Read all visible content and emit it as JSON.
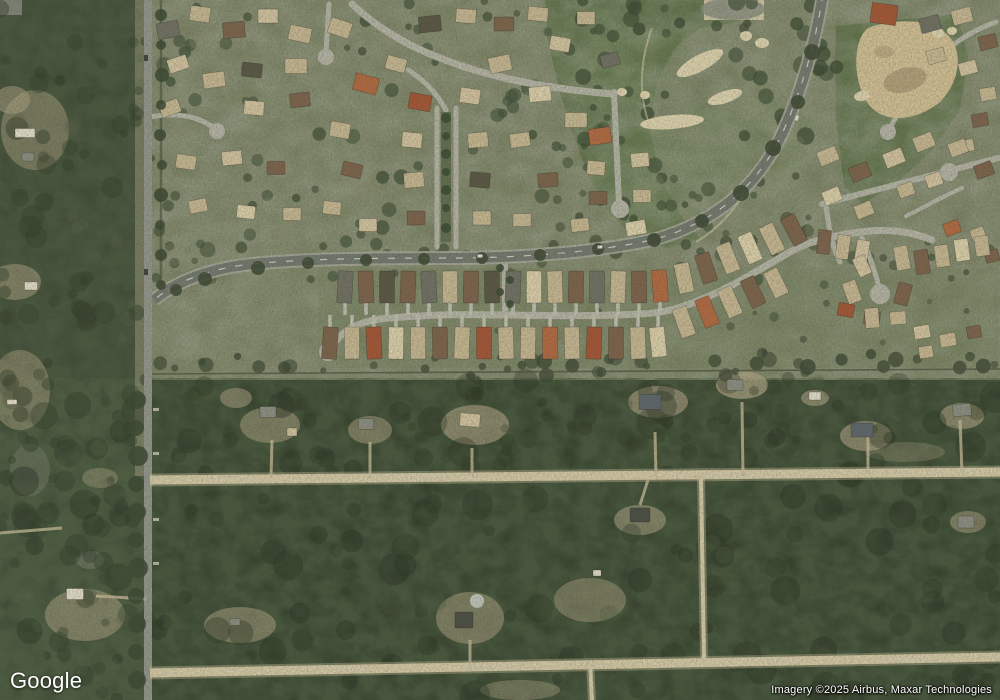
{
  "map": {
    "logo_text": "Google",
    "attribution": "Imagery ©2025 Airbus, Maxar Technologies",
    "palette": {
      "suburbBase": "#7a8161",
      "ruralForest": "#2f3b26",
      "leftForest": "#3a4630",
      "golf": "#5d7046",
      "golfLight": "#6e8052",
      "street": "#b6b5a6",
      "median": "#5f6a4a",
      "roadBed": "#a7a899",
      "mainRoad": "#71766c",
      "verticalRoad": "#92958b",
      "dirt": "#d8cca8",
      "dirtSoft": "#c2b691",
      "sand": "#e2d6b0",
      "waste": "#d5c193",
      "clearing": "#b7a988",
      "wall": "#454c3a",
      "treeDark": "#35432c",
      "centerline": "#f2f2e8",
      "roofs": [
        "#c9b891",
        "#e0d2ab",
        "#7b5f46",
        "#b4663c",
        "#a5512f",
        "#6e6d60",
        "#55523f",
        "#d6c5a0",
        "#e8e1cd",
        "#8a8d80",
        "#5a626a",
        "#454a3e"
      ]
    },
    "base": {
      "suburbRect": [
        150,
        0,
        850,
        380
      ],
      "bandRect": [
        318,
        268,
        680,
        100
      ],
      "leftStripRect": [
        0,
        0,
        150,
        700
      ],
      "golfLeftPoly": "545,0 760,0 756,16 728,24 700,28 676,46 656,84 650,130 660,178 680,214 700,238 668,248 636,238 610,214 590,178 574,138 560,92 548,42",
      "golfRightPoly": "836,26 958,14 968,58 960,110 932,150 896,184 862,204 844,186 836,120 835,60",
      "fairwayLights": [
        [
          700,
          160,
          120,
          55,
          -18,
          0.35
        ],
        [
          630,
          70,
          70,
          38,
          -10,
          0.3
        ],
        [
          900,
          100,
          55,
          60,
          0,
          0.22
        ]
      ]
    },
    "rects": [
      [
        0,
        0,
        22,
        15,
        "#8a8c82",
        0.85
      ],
      [
        135,
        0,
        13,
        476,
        "#a89f82",
        0.5
      ],
      [
        704,
        0,
        60,
        20,
        "#d9cda8",
        0.9
      ],
      [
        318,
        268,
        680,
        100,
        "#76805b",
        0.35
      ]
    ],
    "patches": {
      "tan": [
        [
          270,
          425,
          30,
          18,
          0.5
        ],
        [
          370,
          430,
          22,
          14,
          0.5
        ],
        [
          475,
          425,
          34,
          20,
          0.6
        ],
        [
          658,
          402,
          30,
          16,
          0.6
        ],
        [
          742,
          385,
          26,
          14,
          0.7
        ],
        [
          815,
          398,
          14,
          8,
          0.6
        ],
        [
          866,
          436,
          26,
          15,
          0.6
        ],
        [
          962,
          416,
          22,
          13,
          0.6
        ],
        [
          905,
          452,
          40,
          10,
          0.3
        ],
        [
          640,
          520,
          26,
          15,
          0.55
        ],
        [
          968,
          522,
          18,
          11,
          0.5
        ],
        [
          470,
          618,
          34,
          26,
          0.5
        ],
        [
          590,
          600,
          36,
          22,
          0.45
        ],
        [
          240,
          625,
          36,
          18,
          0.5
        ],
        [
          85,
          615,
          40,
          26,
          0.5
        ],
        [
          20,
          390,
          30,
          40,
          0.45
        ],
        [
          15,
          282,
          26,
          18,
          0.5
        ],
        [
          35,
          130,
          34,
          40,
          0.45
        ],
        [
          12,
          100,
          18,
          14,
          0.5
        ],
        [
          100,
          478,
          18,
          10,
          0.4
        ],
        [
          520,
          690,
          40,
          10,
          0.4
        ],
        [
          236,
          398,
          16,
          10,
          0.5
        ]
      ],
      "gray": [
        [
          733,
          9,
          32,
          11,
          0.9
        ],
        [
          720,
          8,
          7,
          5,
          0.8
        ],
        [
          90,
          560,
          14,
          9,
          0.4
        ],
        [
          30,
          470,
          20,
          26,
          0.3
        ]
      ],
      "pool": [
        477,
        601,
        7,
        7,
        0.9
      ]
    },
    "roads": {
      "streets": [
        {
          "d": "M352,4 C385,35 420,52 462,66 C510,82 560,90 614,94",
          "w": 7
        },
        {
          "d": "M614,92 L619,204",
          "w": 6,
          "bulb": [
            620,
            209,
            9
          ]
        },
        {
          "d": "M437,108 L437,247",
          "w": 5
        },
        {
          "d": "M456,108 L456,247",
          "w": 5
        },
        {
          "d": "M446,110 C436,92 424,80 408,70",
          "w": 5
        },
        {
          "d": "M329,4 L326,52",
          "w": 5,
          "bulb": [
            326,
            57,
            8
          ]
        },
        {
          "d": "M150,117 C176,112 198,116 214,128",
          "w": 5,
          "bulb": [
            217,
            131,
            8
          ]
        },
        {
          "d": "M822,204 L998,158",
          "w": 6,
          "bulb": [
            949,
            172,
            9
          ]
        },
        {
          "d": "M826,206 C830,236 834,252 840,262",
          "w": 5
        },
        {
          "d": "M906,216 C926,206 944,196 962,188",
          "w": 4
        },
        {
          "d": "M996,22 C968,32 948,46 932,66 C916,86 900,108 890,128",
          "w": 5,
          "bulb": [
            888,
            132,
            8
          ]
        },
        {
          "d": "M330,350 C340,330 360,320 390,318 C450,313 470,315 505,315 C560,316 600,316 640,314 C665,313 680,308 700,300 C730,288 755,272 790,252 C805,243 830,236 860,232 C890,228 912,232 932,240",
          "w": 7,
          "bulb": [
            328,
            352,
            9
          ]
        },
        {
          "d": "M505,262 L505,316",
          "w": 6
        },
        {
          "d": "M862,238 C870,256 875,272 879,287",
          "w": 5,
          "bulb": [
            880,
            294,
            10
          ]
        }
      ],
      "medianRect": [
        441,
        112,
        10,
        130
      ],
      "curve": {
        "d": "M823,-6 C816,40 802,92 780,138 C752,194 708,224 656,239 C600,252 520,258 452,258 C372,258 300,259 252,264 C212,268 176,281 154,300",
        "bedW": 14,
        "w": 10,
        "dash": "7 10"
      },
      "vertical": {
        "d": "M148,-4 L148,704",
        "w": 8
      },
      "dirt": [
        {
          "d": "M150,480 C400,477 700,474 1000,472",
          "w": 9
        },
        {
          "d": "M150,673 C400,669 700,662 1000,657",
          "w": 9
        },
        {
          "d": "M701,477 L704,659",
          "w": 4
        },
        {
          "d": "M590,661 L592,702",
          "w": 4
        }
      ],
      "dirtStubs": [
        "M655,432 L656,477",
        "M742,402 L743,476",
        "M868,436 L868,475",
        "M960,420 L962,473",
        "M272,440 L271,478",
        "M370,442 L370,478",
        "M472,448 L472,477",
        "M640,505 L648,480",
        "M470,640 L470,671",
        "M96,596 L146,599",
        "M0,533 L62,528"
      ],
      "aprons": [
        [
          153,
          408
        ],
        [
          153,
          452
        ],
        [
          153,
          518
        ],
        [
          153,
          562
        ]
      ],
      "walls": [
        {
          "d": "M150,374 L1000,369",
          "c": "#454c3a",
          "w": 1.6,
          "o": 0.75
        },
        {
          "d": "M161,0 L161,297",
          "c": "#3f4a33",
          "w": 2.5,
          "o": 0.6
        }
      ],
      "cartPaths": [
        "M652,28 C640,60 638,96 650,126",
        "M696,242 C716,230 734,212 744,192"
      ]
    },
    "golfDetail": {
      "bunkers": [
        [
          700,
          63,
          26,
          8,
          -28
        ],
        [
          725,
          97,
          18,
          6,
          -18
        ],
        [
          746,
          36,
          6,
          5,
          0
        ],
        [
          762,
          43,
          7,
          5,
          0
        ],
        [
          645,
          95,
          5,
          4,
          0
        ],
        [
          622,
          92,
          5,
          4,
          0
        ],
        [
          672,
          122,
          32,
          7,
          -5
        ],
        [
          938,
          33,
          6,
          5,
          0
        ],
        [
          952,
          31,
          5,
          4,
          0
        ],
        [
          862,
          96,
          8,
          5,
          -10
        ]
      ],
      "wastePath": "M868,28 C900,16 938,20 952,40 C964,60 956,86 940,102 C918,120 888,124 872,108 C854,92 850,42 868,28",
      "wasteBlotches": [
        [
          905,
          80,
          22,
          12,
          -15,
          0.45
        ],
        [
          884,
          52,
          10,
          6,
          0,
          0.3
        ]
      ]
    },
    "houses": {
      "clusters": [
        {
          "name": "suburb-west",
          "items": "168,30,22,16,-10,5;200,14,20,15,8,0;234,30,22,16,-5,2;268,16,20,14,0,7;300,34,22,15,12,0;178,64,20,14,-18,7;214,80,22,15,-8,0;252,70,20,14,6,6;296,66,22,15,0,0;170,108,20,14,-20,0;254,108,20,14,5,7;300,100,20,14,-6,2;186,162,20,14,8,0;232,158,20,14,-6,7;276,168,18,13,0,2;198,206,18,13,-12,0;246,212,18,13,6,1;292,214,18,13,0,0"
        },
        {
          "name": "suburb-mid",
          "items": "340,28,22,16,18,0;366,84,24,17,15,3;396,64,20,14,15,0;420,102,22,16,10,4;430,24,22,16,-6,6;466,16,20,14,4,0;470,96,20,15,8,7;500,64,22,16,-12,0;504,24,20,14,0,2;538,14,20,14,6,0;540,94,22,15,-5,1;560,44,20,14,10,7;576,120,22,15,0,0;600,136,22,16,-8,3;586,18,18,13,0,0;610,60,18,13,-15,5;340,130,20,15,10,0;352,170,20,14,14,2;332,208,18,13,6,0;368,225,18,13,0,7;520,140,20,14,-8,0;548,180,20,14,-4,2;522,220,18,13,0,0;580,225,18,13,-6,0"
        },
        {
          "name": "suburb-east-street",
          "items": "596,168,18,14,5,0;640,160,18,14,-5,7;598,198,18,13,0,2;642,196,18,13,0,0;636,228,20,14,-10,1"
        },
        {
          "name": "boulevard-flanks",
          "items": "412,140,20,15,5,7;414,180,20,15,-5,0;416,218,18,14,0,2;478,140,20,15,-5,0;480,180,20,15,5,6;482,218,18,14,0,0"
        },
        {
          "name": "top-right-corner",
          "items": "884,14,26,20,8,4;930,24,20,15,-15,5;962,16,20,15,-15,0;988,42,18,14,-15,2;936,56,18,14,-15,0;968,68,18,13,-15,7;988,94,16,13,-10,0;980,120,16,13,-10,2;966,146,16,12,-12,0"
        },
        {
          "name": "right-mid",
          "items": "828,156,20,15,-22,0;860,172,20,15,-22,2;894,158,20,15,-22,7;924,142,20,15,-22,0;958,148,18,14,-20,0;984,170,18,14,-20,2;832,196,18,14,-22,1;864,210,18,14,-22,0;906,190,16,13,-20,0;934,180,16,13,-20,7"
        },
        {
          "name": "right-rows",
          "items": "824,242,13,24,6,2;843,247,13,24,8,0;862,252,13,24,10,7;952,228,16,13,-20,3;978,234,14,12,-20,0;992,256,14,12,-15,2"
        },
        {
          "name": "band-east",
          "items": "902,258,14,24,-10,0;922,262,14,24,-8,2;942,256,14,22,-8,0;962,250,14,22,-8,1;982,246,14,20,-8,0"
        },
        {
          "name": "right-culdesac",
          "items": "846,310,16,13,10,4;872,318,16,13,5,2;898,318,16,13,-5,0;922,332,16,13,-10,7;948,340,16,13,-10,0;974,332,14,12,-10,2;926,352,14,12,-8,0"
        },
        {
          "name": "band-upper",
          "drive": "down",
          "items": "345,287,15,32,3,5;366,287,15,32,-2,2;387,287,15,32,0,6;408,287,15,32,2,2;429,287,15,32,-3,5;450,287,15,32,0,0;471,287,15,32,1,2;492,287,15,32,-1,6;513,287,15,32,2,5;534,287,15,32,0,1;555,287,15,32,-2,0;576,287,15,32,1,2;597,287,15,32,0,5;618,287,15,32,2,0;639,287,15,32,-1,2;660,286,15,32,-4,3"
        },
        {
          "name": "band-upper-rise",
          "items": "684,278,15,30,-12,0;706,268,15,30,-18,2;728,258,15,30,-22,0;750,248,15,30,-24,1;772,239,15,30,-26,0;794,230,15,30,-28,2"
        },
        {
          "name": "band-lower",
          "drive": "up",
          "items": "330,343,15,32,4,2;352,343,15,32,0,0;374,343,15,32,-2,4;396,343,15,32,1,1;418,343,15,32,0,0;440,343,15,32,-1,2;462,343,15,32,2,0;484,343,15,32,0,4;506,343,15,32,-2,0;528,343,15,32,1,0;550,343,15,32,0,3;572,343,15,32,-1,0;594,343,15,32,2,4;616,343,15,32,0,2;638,343,15,32,-2,0;658,342,15,30,-6,1"
        },
        {
          "name": "band-lower-rise",
          "items": "684,322,15,30,-20,0;707,312,15,30,-22,3;730,302,15,30,-24,0;753,292,15,30,-25,2;776,283,15,28,-26,0"
        },
        {
          "name": "band-bulb",
          "items": "852,292,14,22,-20,0;903,294,14,22,15,2;872,318,14,20,-5,0;862,266,13,20,-25,7"
        },
        {
          "name": "rural-homes",
          "items": "268,412,16,11,0,9;292,432,10,8,0,7;366,424,15,11,0,9;470,420,20,13,5,7;650,402,22,15,0,10;735,385,16,11,0,9;815,396,12,8,0,8;862,430,22,14,0,10;962,410,18,12,-5,9;640,515,20,14,0,11;966,522,16,12,0,9;464,620,18,16,0,11;597,573,8,6,0,8;235,622,10,7,0,9;75,594,17,11,0,8;12,402,10,5,0,8"
        },
        {
          "name": "left-strip",
          "items": "25,133,20,9,0,8;28,157,12,8,0,9;31,286,13,8,0,8"
        }
      ]
    },
    "trees": {
      "regions": [
        {
          "x": 150,
          "y": 0,
          "w": 690,
          "h": 250,
          "n": 120,
          "rMin": 3,
          "rMax": 8,
          "c": "#3c4b32",
          "o": 0.8,
          "s": 1
        },
        {
          "x": 150,
          "y": 240,
          "w": 850,
          "h": 40,
          "n": 38,
          "rMin": 3,
          "rMax": 7,
          "c": "#3c4b32",
          "o": 0.75,
          "s": 2
        },
        {
          "x": 150,
          "y": 352,
          "w": 850,
          "h": 24,
          "n": 46,
          "rMin": 3,
          "rMax": 8,
          "c": "#33402a",
          "o": 0.8,
          "s": 3
        },
        {
          "x": 320,
          "y": 278,
          "w": 660,
          "h": 70,
          "n": 16,
          "rMin": 2,
          "rMax": 5,
          "c": "#3c4b32",
          "o": 0.7,
          "s": 4
        },
        {
          "x": 560,
          "y": 0,
          "w": 290,
          "h": 235,
          "n": 30,
          "rMin": 4,
          "rMax": 9,
          "c": "#36452c",
          "o": 0.8,
          "s": 5
        },
        {
          "x": 0,
          "y": 380,
          "w": 1000,
          "h": 318,
          "n": 150,
          "rMin": 5,
          "rMax": 16,
          "c": "#222d1b",
          "o": 0.45,
          "s": 6
        },
        {
          "x": 0,
          "y": 380,
          "w": 1000,
          "h": 318,
          "n": 90,
          "rMin": 3,
          "rMax": 10,
          "c": "#4a5539",
          "o": 0.35,
          "s": 7
        },
        {
          "x": 0,
          "y": 0,
          "w": 148,
          "h": 700,
          "n": 90,
          "rMin": 4,
          "rMax": 12,
          "c": "#2c3823",
          "o": 0.5,
          "s": 8
        },
        {
          "x": 0,
          "y": 0,
          "w": 148,
          "h": 700,
          "n": 50,
          "rMin": 3,
          "rMax": 8,
          "c": "#5a6147",
          "o": 0.3,
          "s": 9
        },
        {
          "x": 150,
          "y": 0,
          "w": 680,
          "h": 255,
          "n": 40,
          "rMin": 5,
          "rMax": 12,
          "c": "#8d9272",
          "o": 0.3,
          "s": 10
        },
        {
          "x": 150,
          "y": 378,
          "w": 850,
          "h": 95,
          "n": 40,
          "rMin": 4,
          "rMax": 10,
          "c": "#273219",
          "o": 0.4,
          "s": 11
        }
      ],
      "rows": [
        [
          137,
          400,
          9
        ],
        [
          136,
          428,
          8
        ],
        [
          138,
          456,
          10
        ],
        [
          136,
          484,
          8
        ],
        [
          137,
          512,
          9
        ],
        [
          136,
          540,
          8
        ],
        [
          138,
          568,
          10
        ],
        [
          136,
          596,
          8
        ],
        [
          137,
          624,
          9
        ],
        [
          136,
          652,
          8
        ],
        [
          137,
          680,
          9
        ],
        [
          161,
          15,
          6
        ],
        [
          161,
          45,
          5
        ],
        [
          162,
          75,
          7
        ],
        [
          161,
          105,
          5
        ],
        [
          160,
          135,
          6
        ],
        [
          162,
          165,
          5
        ],
        [
          161,
          195,
          7
        ],
        [
          160,
          225,
          5
        ],
        [
          161,
          255,
          6
        ],
        [
          161,
          285,
          5
        ],
        [
          812,
          52,
          8
        ],
        [
          798,
          102,
          7
        ],
        [
          773,
          148,
          8
        ],
        [
          741,
          193,
          8
        ],
        [
          702,
          221,
          7
        ],
        [
          654,
          240,
          7
        ],
        [
          598,
          249,
          6
        ],
        [
          540,
          255,
          6
        ],
        [
          482,
          258,
          6
        ],
        [
          424,
          259,
          6
        ],
        [
          366,
          260,
          6
        ],
        [
          308,
          263,
          6
        ],
        [
          258,
          268,
          7
        ],
        [
          205,
          279,
          7
        ],
        [
          176,
          290,
          6
        ],
        [
          446,
          118,
          5
        ],
        [
          446,
          136,
          4
        ],
        [
          446,
          154,
          5
        ],
        [
          446,
          172,
          4
        ],
        [
          446,
          190,
          5
        ],
        [
          446,
          208,
          4
        ],
        [
          446,
          228,
          5
        ],
        [
          500,
          268,
          4
        ],
        [
          510,
          280,
          4
        ],
        [
          500,
          292,
          4
        ],
        [
          510,
          304,
          4
        ]
      ]
    },
    "vehicles": {
      "light": [
        [
          600,
          247,
          5,
          3,
          -4
        ],
        [
          480,
          256,
          5,
          3,
          0
        ],
        [
          797,
          118,
          3,
          5,
          20
        ]
      ],
      "dark": [
        [
          146,
          58,
          4,
          6,
          0
        ],
        [
          146,
          272,
          4,
          6,
          0
        ]
      ]
    }
  }
}
